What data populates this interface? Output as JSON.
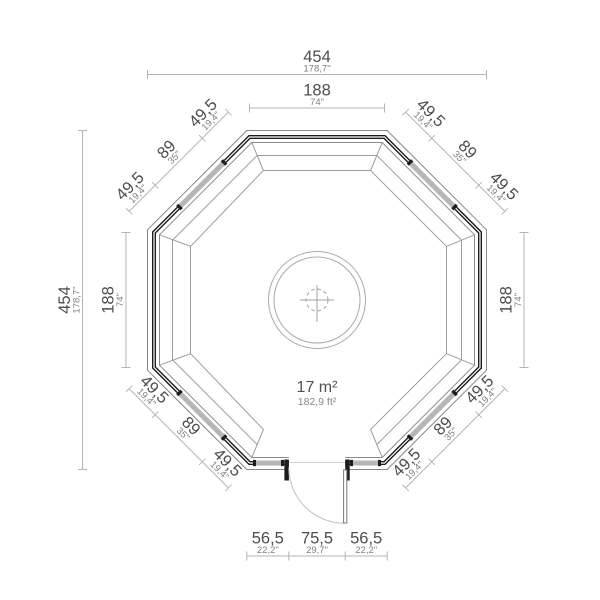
{
  "drawing": {
    "type": "octagonal-cabin-floor-plan",
    "area": {
      "metric": "17 m²",
      "imperial": "182,9 ft²"
    },
    "colors": {
      "wall": "#1c1c1e",
      "dimension_line": "#b3b5b7",
      "dimension_text_primary": "#4c4e50",
      "dimension_text_secondary": "#7d7f82",
      "window_band": "#b4b6b8"
    }
  },
  "dims": {
    "overall_width": {
      "cm": "454",
      "inch": "178,7\""
    },
    "overall_height": {
      "cm": "454",
      "inch": "178,7\""
    },
    "top_wall": {
      "cm": "188",
      "inch": "74\""
    },
    "left_wall": {
      "cm": "188",
      "inch": "74\""
    },
    "right_wall": {
      "cm": "188",
      "inch": "74\""
    },
    "bottom_left_wall": {
      "cm": "56,5",
      "inch": "22,2\""
    },
    "door_opening": {
      "cm": "75,5",
      "inch": "29,7\""
    },
    "bottom_right_wall": {
      "cm": "56,5",
      "inch": "22,2\""
    },
    "diagonal_wall": {
      "corner": {
        "cm": "49,5",
        "inch": "19,4\""
      },
      "window": {
        "cm": "89",
        "inch": "35\""
      }
    }
  }
}
